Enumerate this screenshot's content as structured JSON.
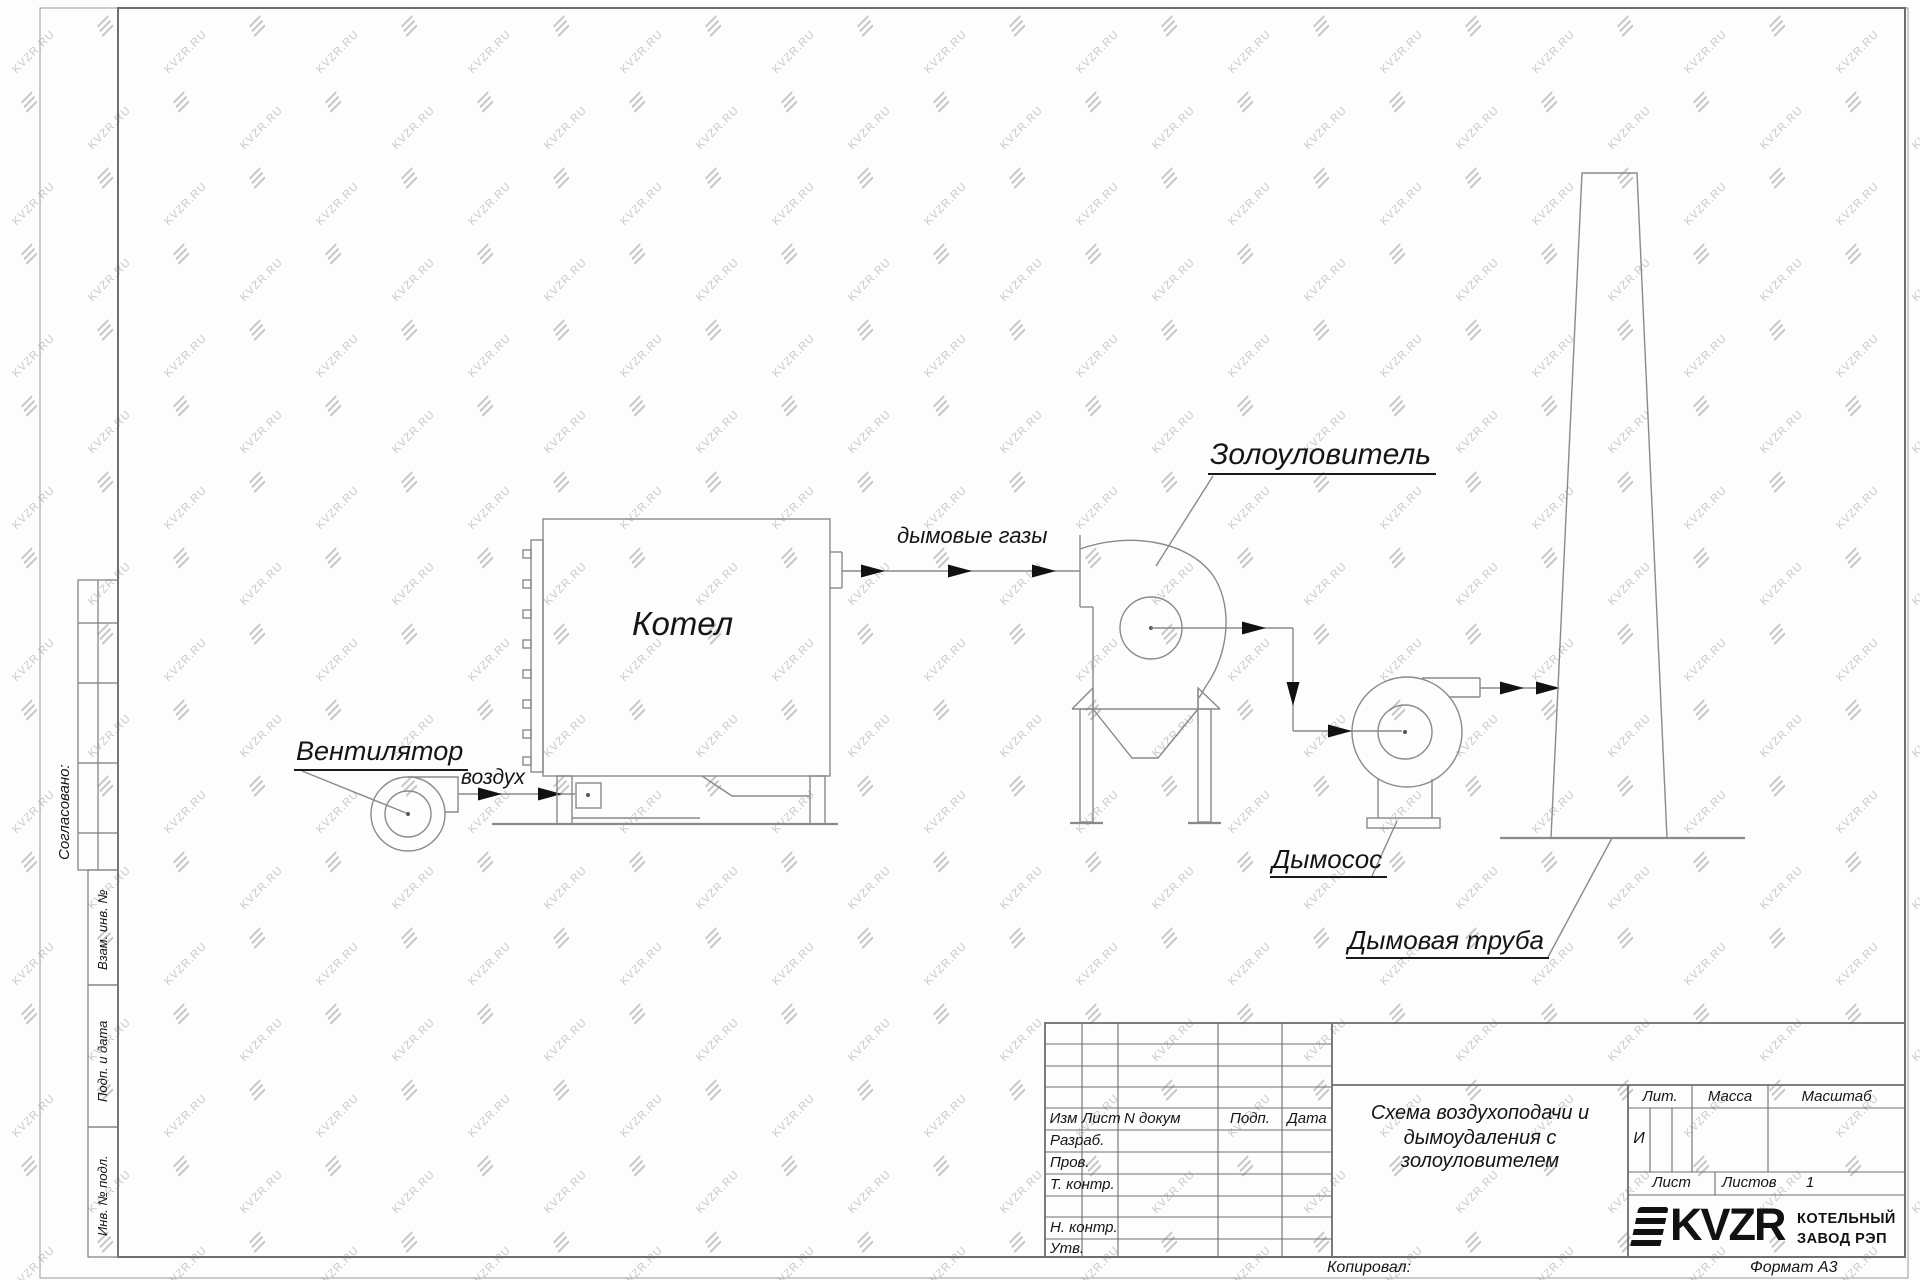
{
  "watermark": {
    "text": "KVZR.RU"
  },
  "colors": {
    "line": "#8a8a8a",
    "frame": "#6e6e6e",
    "text": "#151515",
    "watermark": "#c9c9c9",
    "arrow": "#111111"
  },
  "sidebar": {
    "approved_label": "Согласовано:",
    "boxes": [
      "Взам. инв. №",
      "Подп. и дата",
      "Инв. № подл."
    ]
  },
  "diagram": {
    "labels": {
      "fan": "Вентилятор",
      "air": "воздух",
      "boiler": "Котел",
      "flue_gases": "дымовые газы",
      "ash_catcher": "Золоуловитель",
      "smoke_exhauster": "Дымосос",
      "chimney": "Дымовая труба"
    }
  },
  "title_block": {
    "rev_header": {
      "izm": "Изм",
      "list": "Лист",
      "doc": "N докум",
      "podp": "Подп.",
      "data": "Дата"
    },
    "rows": {
      "razrab": "Разраб.",
      "prov": "Пров.",
      "t_kontr": "Т. контр.",
      "n_kontr": "Н. контр.",
      "utv": "Утв."
    },
    "title_lines": [
      "Схема воздухоподачи и",
      "дымоудаления с",
      "золоуловителем"
    ],
    "lit": {
      "label": "Лит.",
      "value": "И"
    },
    "massa_label": "Масса",
    "masshtab_label": "Масштаб",
    "list_label": "Лист",
    "listov_label": "Листов",
    "listov_value": "1",
    "logo": {
      "text": "KVZR",
      "line1": "КОТЕЛЬНЫЙ",
      "line2": "ЗАВОД РЭП"
    },
    "kopiroval": "Копировал:",
    "format": "Формат А3"
  }
}
